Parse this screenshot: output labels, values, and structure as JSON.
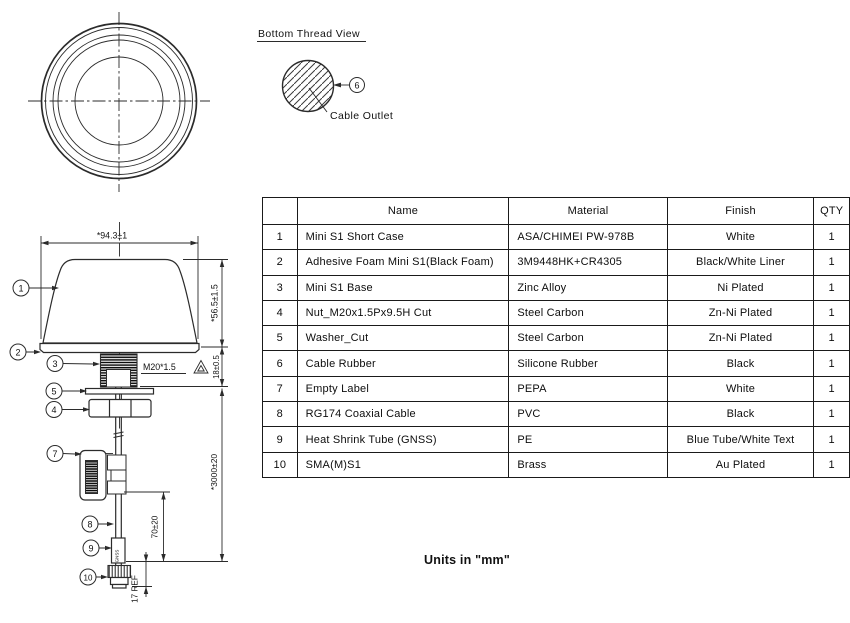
{
  "thread_view": {
    "title": "Bottom Thread View",
    "cable_outlet": "Cable Outlet"
  },
  "side_view": {
    "dim_width": "*94.3±1",
    "dim_height": "*56.5±1.5",
    "dim_thread_length": "18±0.5",
    "thread_spec": "M20*1.5",
    "dim_cable_length": "*3000±20",
    "dim_shrink_offset": "70±20",
    "dim_connector": "17 REF",
    "shrink_text": "GNSS"
  },
  "balloons": {
    "b1": "1",
    "b2": "2",
    "b3": "3",
    "b4": "4",
    "b5": "5",
    "b6": "6",
    "b7": "7",
    "b8": "8",
    "b9": "9",
    "b10": "10"
  },
  "parts_table": {
    "headers": {
      "no": "",
      "name": "Name",
      "material": "Material",
      "finish": "Finish",
      "qty": "QTY"
    },
    "rows": [
      {
        "no": "1",
        "name": "Mini S1 Short Case",
        "material": "ASA/CHIMEI PW-978B",
        "finish": "White",
        "qty": "1"
      },
      {
        "no": "2",
        "name": "Adhesive Foam Mini S1(Black Foam)",
        "material": "3M9448HK+CR4305",
        "finish": "Black/White Liner",
        "qty": "1"
      },
      {
        "no": "3",
        "name": "Mini S1 Base",
        "material": "Zinc Alloy",
        "finish": "Ni Plated",
        "qty": "1"
      },
      {
        "no": "4",
        "name": "Nut_M20x1.5Px9.5H Cut",
        "material": "Steel Carbon",
        "finish": "Zn-Ni Plated",
        "qty": "1"
      },
      {
        "no": "5",
        "name": "Washer_Cut",
        "material": "Steel Carbon",
        "finish": "Zn-Ni Plated",
        "qty": "1"
      },
      {
        "no": "6",
        "name": "Cable Rubber",
        "material": "Silicone Rubber",
        "finish": "Black",
        "qty": "1"
      },
      {
        "no": "7",
        "name": "Empty Label",
        "material": "PEPA",
        "finish": "White",
        "qty": "1"
      },
      {
        "no": "8",
        "name": "RG174 Coaxial Cable",
        "material": "PVC",
        "finish": "Black",
        "qty": "1"
      },
      {
        "no": "9",
        "name": "Heat Shrink Tube (GNSS)",
        "material": "PE",
        "finish": "Blue Tube/White Text",
        "qty": "1"
      },
      {
        "no": "10",
        "name": "SMA(M)S1",
        "material": "Brass",
        "finish": "Au Plated",
        "qty": "1"
      }
    ]
  },
  "footer": {
    "units_note": "Units in \"mm\""
  }
}
